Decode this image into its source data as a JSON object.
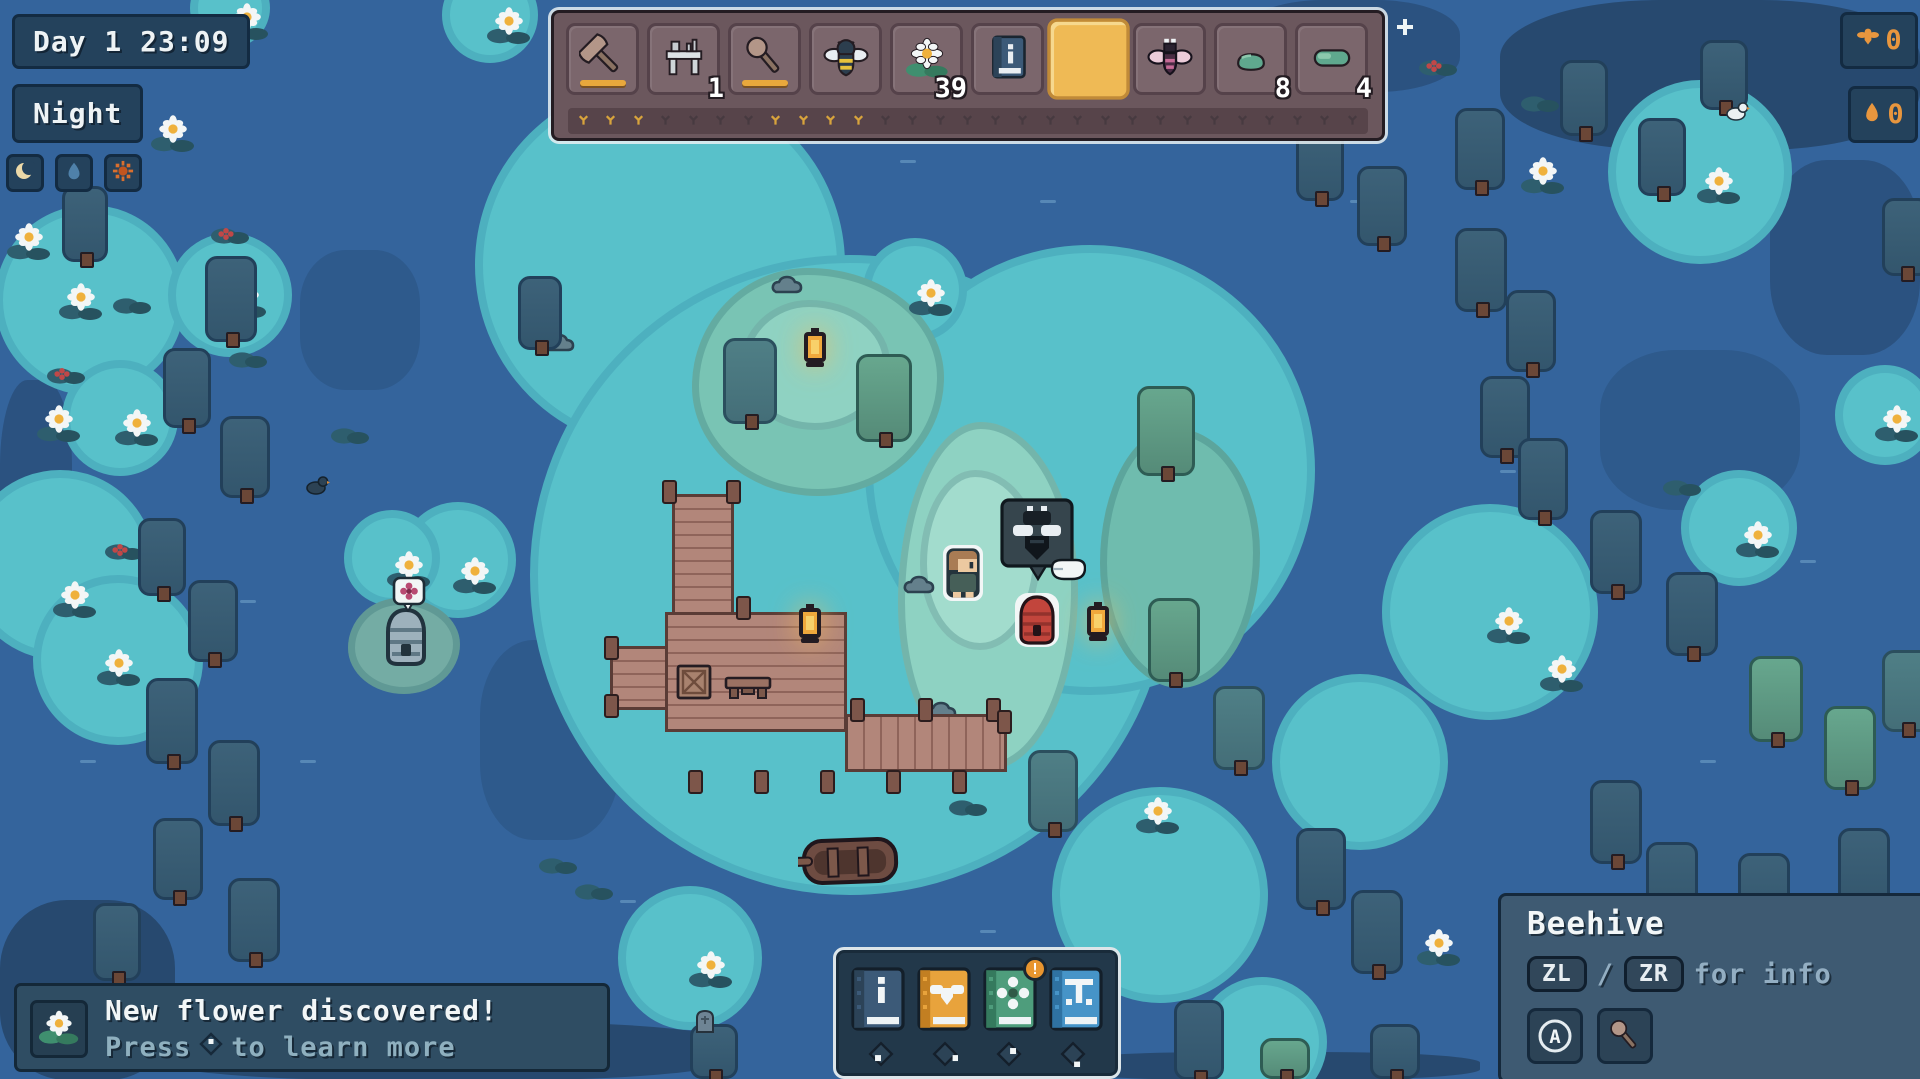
{
  "palette": {
    "water": "#34649c",
    "water_dark": "#27496f",
    "glow": "#58c1ca",
    "grass_lit": "#8ed2c2",
    "grass": "#79c4b4",
    "wood": "#b2867a",
    "ui_navy": "#24425c",
    "ui_slate": "#3e5a72",
    "hotbar": "#6b575d",
    "slot_selected": "#efba55",
    "accent_orange": "#e8963e",
    "durability": "#e8a83c",
    "beehive_red": "#c2453c",
    "marker_gold": "#d8a43c"
  },
  "hud": {
    "clock": {
      "label": "Day 1 23:09"
    },
    "phase": {
      "label": "Night"
    },
    "phase_icons": [
      {
        "name": "moon"
      },
      {
        "name": "water-drop"
      },
      {
        "name": "sun"
      }
    ],
    "counters": [
      {
        "icon": "bee",
        "value": "0"
      },
      {
        "icon": "honey-drop",
        "value": "0"
      }
    ],
    "hotbar": {
      "slots": [
        {
          "icon": "axe",
          "durability": true
        },
        {
          "icon": "workbench",
          "count": "1"
        },
        {
          "icon": "hammer",
          "durability": true
        },
        {
          "icon": "bee"
        },
        {
          "icon": "waterlily",
          "count": "39"
        },
        {
          "icon": "info-book"
        },
        {
          "icon": "empty",
          "selected": true
        },
        {
          "icon": "moth"
        },
        {
          "icon": "clay",
          "count": "8"
        },
        {
          "icon": "log",
          "count": "4"
        }
      ],
      "markers": {
        "total": 29,
        "gold": [
          0,
          1,
          2,
          7,
          8,
          9,
          10
        ]
      }
    },
    "notification": {
      "title": "New flower discovered!",
      "press_label": "Press",
      "more_label": "to learn more"
    },
    "dock_books": {
      "items": [
        {
          "name": "help-book",
          "color": "#3c5a78",
          "edge": "#2c4358",
          "glyph": "i",
          "dpad": "left"
        },
        {
          "name": "bee-book",
          "color": "#e8a33c",
          "edge": "#c27f22",
          "glyph": "bee",
          "dpad": "right",
          "badge": ""
        },
        {
          "name": "flower-book",
          "color": "#4e9d7c",
          "edge": "#357a5e",
          "glyph": "flower",
          "dpad": "up",
          "badge": "!"
        },
        {
          "name": "pier-book",
          "color": "#4694c8",
          "edge": "#2f72a2",
          "glyph": "pier",
          "dpad": "down"
        }
      ]
    },
    "tooltip": {
      "title": "Beehive",
      "key1": "ZL",
      "sep": "/",
      "key2": "ZR",
      "hint": "for info",
      "action_key": "A",
      "action_icon": "hammer"
    }
  },
  "world": {
    "patches": [
      [
        0,
        900,
        175,
        180,
        "#27496f"
      ],
      [
        0,
        380,
        72,
        225,
        "#2b5280"
      ],
      [
        1500,
        0,
        420,
        150,
        "#27496f"
      ],
      [
        1240,
        0,
        220,
        92,
        "#2b5280"
      ],
      [
        1770,
        160,
        150,
        195,
        "#2b5280"
      ],
      [
        150,
        1022,
        585,
        58,
        "#27496f"
      ],
      [
        1060,
        1052,
        420,
        28,
        "#27496f"
      ],
      [
        300,
        250,
        120,
        140,
        "#2e5a8c"
      ],
      [
        480,
        640,
        140,
        200,
        "#2e5a8c"
      ],
      [
        1600,
        350,
        200,
        160,
        "#2e5a8c"
      ]
    ],
    "dashes": [
      [
        500,
        200
      ],
      [
        900,
        160
      ],
      [
        1250,
        330
      ],
      [
        420,
        520
      ],
      [
        300,
        760
      ],
      [
        620,
        900
      ],
      [
        1080,
        300
      ],
      [
        1500,
        470
      ],
      [
        1650,
        900
      ],
      [
        1800,
        560
      ],
      [
        1150,
        640
      ],
      [
        760,
        420
      ],
      [
        980,
        930
      ],
      [
        80,
        760
      ],
      [
        1350,
        200
      ],
      [
        560,
        80
      ],
      [
        240,
        600
      ],
      [
        1700,
        760
      ],
      [
        1870,
        960
      ],
      [
        1040,
        200
      ]
    ],
    "glows": [
      [
        660,
        265,
        185
      ],
      [
        850,
        575,
        320
      ],
      [
        1090,
        470,
        225
      ],
      [
        90,
        300,
        95
      ],
      [
        230,
        295,
        62
      ],
      [
        60,
        565,
        95
      ],
      [
        118,
        660,
        85
      ],
      [
        120,
        418,
        58
      ],
      [
        458,
        560,
        58
      ],
      [
        392,
        558,
        48
      ],
      [
        1490,
        612,
        108
      ],
      [
        1700,
        172,
        92
      ],
      [
        1739,
        528,
        58
      ],
      [
        1360,
        762,
        88
      ],
      [
        1160,
        895,
        108
      ],
      [
        915,
        290,
        52
      ],
      [
        690,
        958,
        72
      ],
      [
        1262,
        1042,
        65
      ],
      [
        490,
        15,
        48
      ],
      [
        230,
        8,
        40
      ],
      [
        1885,
        415,
        50
      ]
    ],
    "islands": [
      [
        692,
        268,
        252,
        228,
        "#79c4b4"
      ],
      [
        740,
        300,
        150,
        130,
        "#8fd2c2"
      ],
      [
        898,
        422,
        180,
        348,
        "#8ed2c2"
      ],
      [
        920,
        470,
        120,
        180,
        "#a2dccd"
      ],
      [
        1100,
        428,
        160,
        260,
        "#6fbcae"
      ],
      [
        348,
        598,
        112,
        96,
        "#74aca4"
      ]
    ],
    "trees": [
      [
        62,
        186,
        46,
        76,
        "d"
      ],
      [
        205,
        256,
        52,
        86,
        "d"
      ],
      [
        163,
        348,
        48,
        80,
        "d"
      ],
      [
        220,
        416,
        50,
        82,
        "d"
      ],
      [
        138,
        518,
        48,
        78,
        "d"
      ],
      [
        188,
        580,
        50,
        82,
        "d"
      ],
      [
        146,
        678,
        52,
        86,
        "d"
      ],
      [
        208,
        740,
        52,
        86,
        "d"
      ],
      [
        153,
        818,
        50,
        82,
        "d"
      ],
      [
        228,
        878,
        52,
        84,
        "d"
      ],
      [
        93,
        903,
        48,
        78,
        "d"
      ],
      [
        518,
        276,
        44,
        74,
        "d"
      ],
      [
        723,
        338,
        54,
        86,
        "m"
      ],
      [
        856,
        354,
        56,
        88,
        "l"
      ],
      [
        1137,
        386,
        58,
        90,
        "l"
      ],
      [
        1148,
        598,
        52,
        84,
        "l"
      ],
      [
        1213,
        686,
        52,
        84,
        "m"
      ],
      [
        1028,
        750,
        50,
        82,
        "m"
      ],
      [
        1455,
        108,
        50,
        82,
        "d"
      ],
      [
        1296,
        123,
        48,
        78,
        "d"
      ],
      [
        1357,
        166,
        50,
        80,
        "d"
      ],
      [
        1455,
        228,
        52,
        84,
        "d"
      ],
      [
        1506,
        290,
        50,
        82,
        "d"
      ],
      [
        1480,
        376,
        50,
        82,
        "d"
      ],
      [
        1518,
        438,
        50,
        82,
        "d"
      ],
      [
        1590,
        510,
        52,
        84,
        "d"
      ],
      [
        1666,
        572,
        52,
        84,
        "d"
      ],
      [
        1749,
        656,
        54,
        86,
        "l"
      ],
      [
        1824,
        706,
        52,
        84,
        "l"
      ],
      [
        1882,
        650,
        50,
        82,
        "m"
      ],
      [
        1590,
        780,
        52,
        84,
        "d"
      ],
      [
        1646,
        842,
        52,
        84,
        "d"
      ],
      [
        1738,
        853,
        52,
        84,
        "d"
      ],
      [
        1838,
        828,
        52,
        84,
        "d"
      ],
      [
        1296,
        828,
        50,
        82,
        "d"
      ],
      [
        1351,
        890,
        52,
        84,
        "d"
      ],
      [
        1174,
        1000,
        50,
        80,
        "d"
      ],
      [
        1260,
        1038,
        50,
        41,
        "l"
      ],
      [
        1370,
        1024,
        50,
        55,
        "d"
      ],
      [
        690,
        1024,
        48,
        55,
        "d"
      ],
      [
        1638,
        118,
        48,
        78,
        "d"
      ],
      [
        1882,
        198,
        48,
        78,
        "d"
      ],
      [
        1700,
        40,
        48,
        70,
        "d"
      ],
      [
        1560,
        60,
        48,
        76,
        "d"
      ]
    ],
    "decor": [
      {
        "t": "lily",
        "x": 6,
        "y": 222
      },
      {
        "t": "lily",
        "x": 58,
        "y": 282
      },
      {
        "t": "lily",
        "x": 222,
        "y": 280
      },
      {
        "t": "lily",
        "x": 36,
        "y": 404
      },
      {
        "t": "lily",
        "x": 114,
        "y": 408
      },
      {
        "t": "lily",
        "x": 150,
        "y": 114
      },
      {
        "t": "lily",
        "x": 486,
        "y": 6
      },
      {
        "t": "lily",
        "x": 224,
        "y": 2
      },
      {
        "t": "lily",
        "x": 908,
        "y": 278
      },
      {
        "t": "lily",
        "x": 1520,
        "y": 156
      },
      {
        "t": "lily",
        "x": 1696,
        "y": 166
      },
      {
        "t": "lily",
        "x": 1735,
        "y": 520
      },
      {
        "t": "lily",
        "x": 1539,
        "y": 654
      },
      {
        "t": "lily",
        "x": 1416,
        "y": 928
      },
      {
        "t": "lily",
        "x": 1135,
        "y": 796
      },
      {
        "t": "lily",
        "x": 52,
        "y": 580
      },
      {
        "t": "lily",
        "x": 96,
        "y": 648
      },
      {
        "t": "lily",
        "x": 386,
        "y": 550
      },
      {
        "t": "lily",
        "x": 452,
        "y": 556
      },
      {
        "t": "lily",
        "x": 688,
        "y": 950
      },
      {
        "t": "lily",
        "x": 1486,
        "y": 606
      },
      {
        "t": "lily",
        "x": 1874,
        "y": 404
      },
      {
        "t": "pad",
        "x": 112,
        "y": 294
      },
      {
        "t": "pad",
        "x": 228,
        "y": 348
      },
      {
        "t": "pad",
        "x": 330,
        "y": 424
      },
      {
        "t": "pad",
        "x": 538,
        "y": 854
      },
      {
        "t": "pad",
        "x": 574,
        "y": 880
      },
      {
        "t": "pad",
        "x": 948,
        "y": 796
      },
      {
        "t": "pad",
        "x": 1662,
        "y": 476
      },
      {
        "t": "pad",
        "x": 1520,
        "y": 92
      },
      {
        "t": "redpad",
        "x": 210,
        "y": 224
      },
      {
        "t": "redpad",
        "x": 46,
        "y": 364
      },
      {
        "t": "redpad",
        "x": 104,
        "y": 540
      },
      {
        "t": "redpad",
        "x": 1418,
        "y": 56
      },
      {
        "t": "rock",
        "x": 768,
        "y": 270
      },
      {
        "t": "rock",
        "x": 922,
        "y": 696
      },
      {
        "t": "rock",
        "x": 540,
        "y": 328
      },
      {
        "t": "rock",
        "x": 900,
        "y": 570
      }
    ],
    "dock": {
      "rects": [
        [
          672,
          494,
          62,
          126,
          "h"
        ],
        [
          665,
          612,
          182,
          120,
          "h"
        ],
        [
          610,
          646,
          58,
          64,
          "h"
        ],
        [
          845,
          714,
          162,
          58,
          "v"
        ]
      ],
      "posts": [
        [
          662,
          480
        ],
        [
          726,
          480
        ],
        [
          736,
          596
        ],
        [
          604,
          636
        ],
        [
          604,
          694
        ],
        [
          850,
          698
        ],
        [
          918,
          698
        ],
        [
          986,
          698
        ],
        [
          688,
          770
        ],
        [
          754,
          770
        ],
        [
          820,
          770
        ],
        [
          886,
          770
        ],
        [
          952,
          770
        ],
        [
          997,
          710
        ]
      ]
    },
    "objects": [
      {
        "t": "skep",
        "x": 380,
        "y": 606
      },
      {
        "t": "flowerbubble",
        "x": 392,
        "y": 576
      },
      {
        "t": "boat",
        "x": 798,
        "y": 832
      },
      {
        "t": "crate",
        "x": 676,
        "y": 662
      },
      {
        "t": "bench",
        "x": 724,
        "y": 674
      },
      {
        "t": "lantern",
        "x": 795,
        "y": 604
      },
      {
        "t": "lantern",
        "x": 800,
        "y": 328
      },
      {
        "t": "lantern",
        "x": 1083,
        "y": 602
      },
      {
        "t": "character",
        "x": 942,
        "y": 544
      },
      {
        "t": "beebubble",
        "x": 1000,
        "y": 498
      },
      {
        "t": "hand",
        "x": 1048,
        "y": 552
      },
      {
        "t": "beehive",
        "x": 1014,
        "y": 592
      },
      {
        "t": "bird",
        "x": 304,
        "y": 474
      },
      {
        "t": "birdw",
        "x": 1724,
        "y": 100
      },
      {
        "t": "tomb",
        "x": 694,
        "y": 1008
      },
      {
        "t": "sparkle",
        "x": 1396,
        "y": 18
      }
    ]
  }
}
